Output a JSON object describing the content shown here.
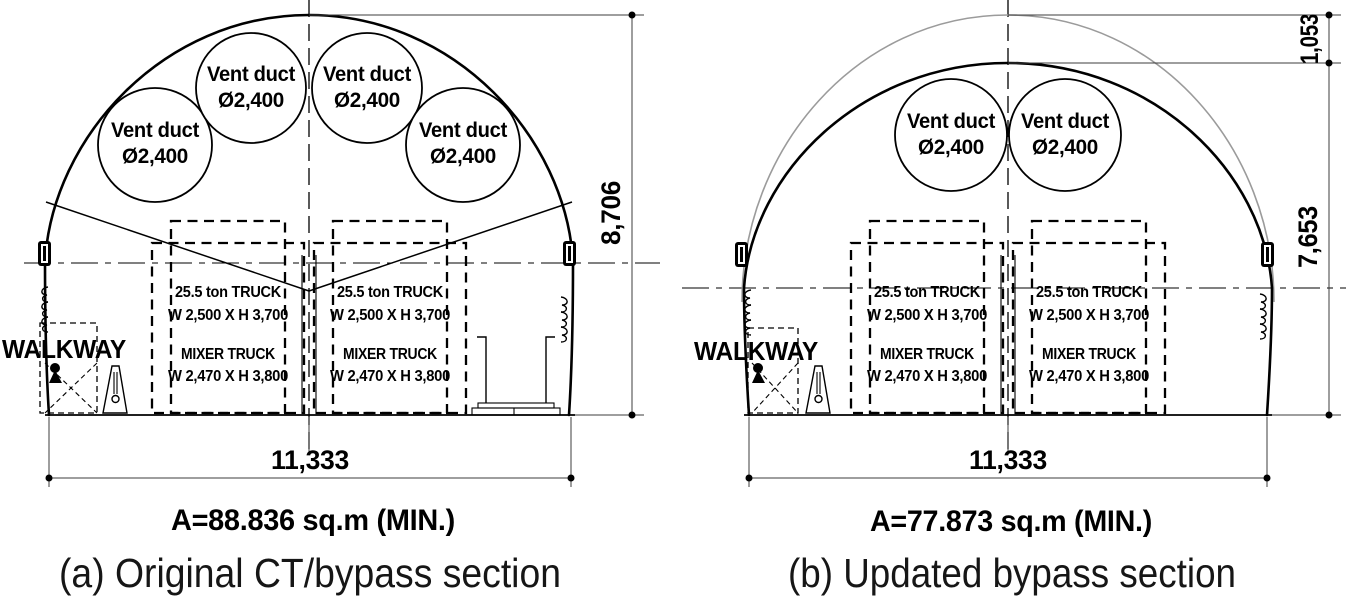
{
  "labels": {
    "vent_line1": "Vent duct",
    "vent_line2": "Ø2,400",
    "truck_line1": "25.5 ton TRUCK",
    "truck_line2": "W 2,500 X H 3,700",
    "truck_line3": "MIXER TRUCK",
    "truck_line4": "W 2,470 X H 3,800",
    "walkway": "WALKWAY",
    "width_dim": "11,333"
  },
  "diagram_a": {
    "caption": "(a) Original CT/bypass section",
    "area": "A=88.836 sq.m (MIN.)",
    "height_dim": "8,706",
    "vent_duct_count": 4
  },
  "diagram_b": {
    "caption": "(b) Updated bypass section",
    "area": "A=77.873 sq.m (MIN.)",
    "crown_drop_dim": "1,053",
    "height_dim": "7,653",
    "vent_duct_count": 2
  },
  "colors": {
    "line": "#000000",
    "dim_line": "#3c3c3c",
    "removed_profile": "#9b9b9b",
    "background": "#ffffff"
  }
}
